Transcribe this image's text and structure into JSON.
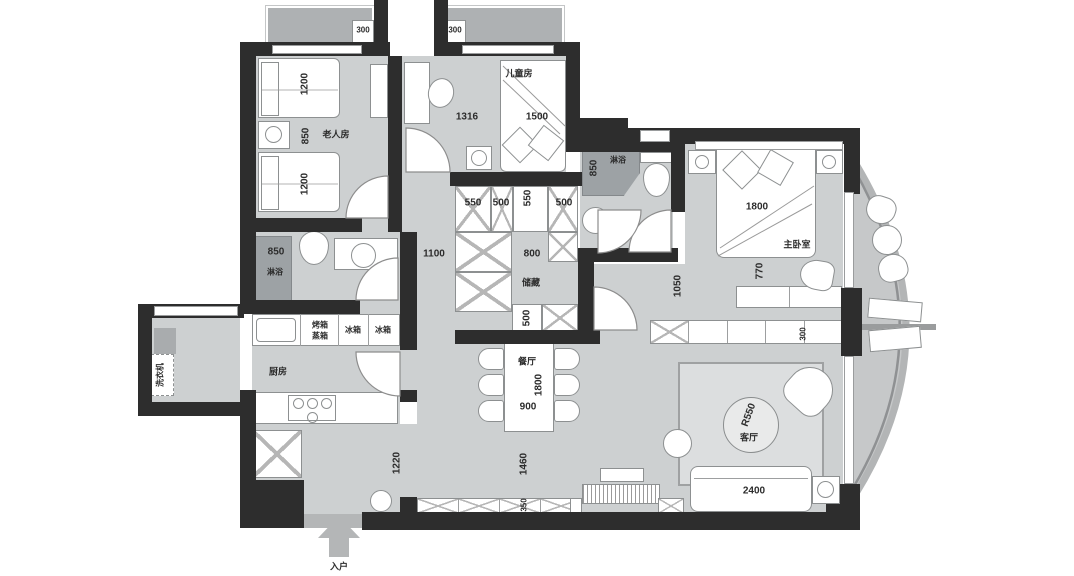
{
  "plan": {
    "type": "apartment-floor-plan",
    "rooms": {
      "elder": "老人房",
      "kids": "儿童房",
      "master": "主卧室",
      "storage": "储藏",
      "kitchen": "厨房",
      "dining": "餐厅",
      "living": "客厅",
      "entry": "入户"
    },
    "fixtures": {
      "shower1": "淋浴",
      "shower2": "淋浴",
      "washer": "洗衣机",
      "oven": "烤箱",
      "steamer": "蒸箱",
      "fridge1": "冰箱",
      "fridge2": "冰箱"
    },
    "dims": {
      "bay_a": "300",
      "bay_b": "300",
      "elder_bed_top": "1200",
      "elder_gap": "850",
      "elder_bed_bottom": "1200",
      "kids_left": "1316",
      "kids_bed": "1500",
      "bath1": "850",
      "bath2": "850",
      "wardrobe_550a": "550",
      "wardrobe_500a": "500",
      "wardrobe_550b": "550",
      "wardrobe_500b": "500",
      "hall": "1100",
      "wardrobe_800": "800",
      "wardrobe_500c": "500",
      "master_bed": "1800",
      "master_gap": "770",
      "corridor": "1050",
      "cabinet_depth": "300",
      "dining_table_len": "1800",
      "dining_table_wid": "900",
      "dining_clear": "1460",
      "bench": "350",
      "entry_opening": "1220",
      "sofa": "2400",
      "rug_radius": "R550"
    },
    "colors": {
      "wall": "#2d2d2d",
      "floor": "#cdd0d1",
      "bay": "#aeb1b3",
      "shower": "#9da2a5",
      "balcony": "#c6c8c9",
      "accent_white": "#ffffff"
    }
  }
}
